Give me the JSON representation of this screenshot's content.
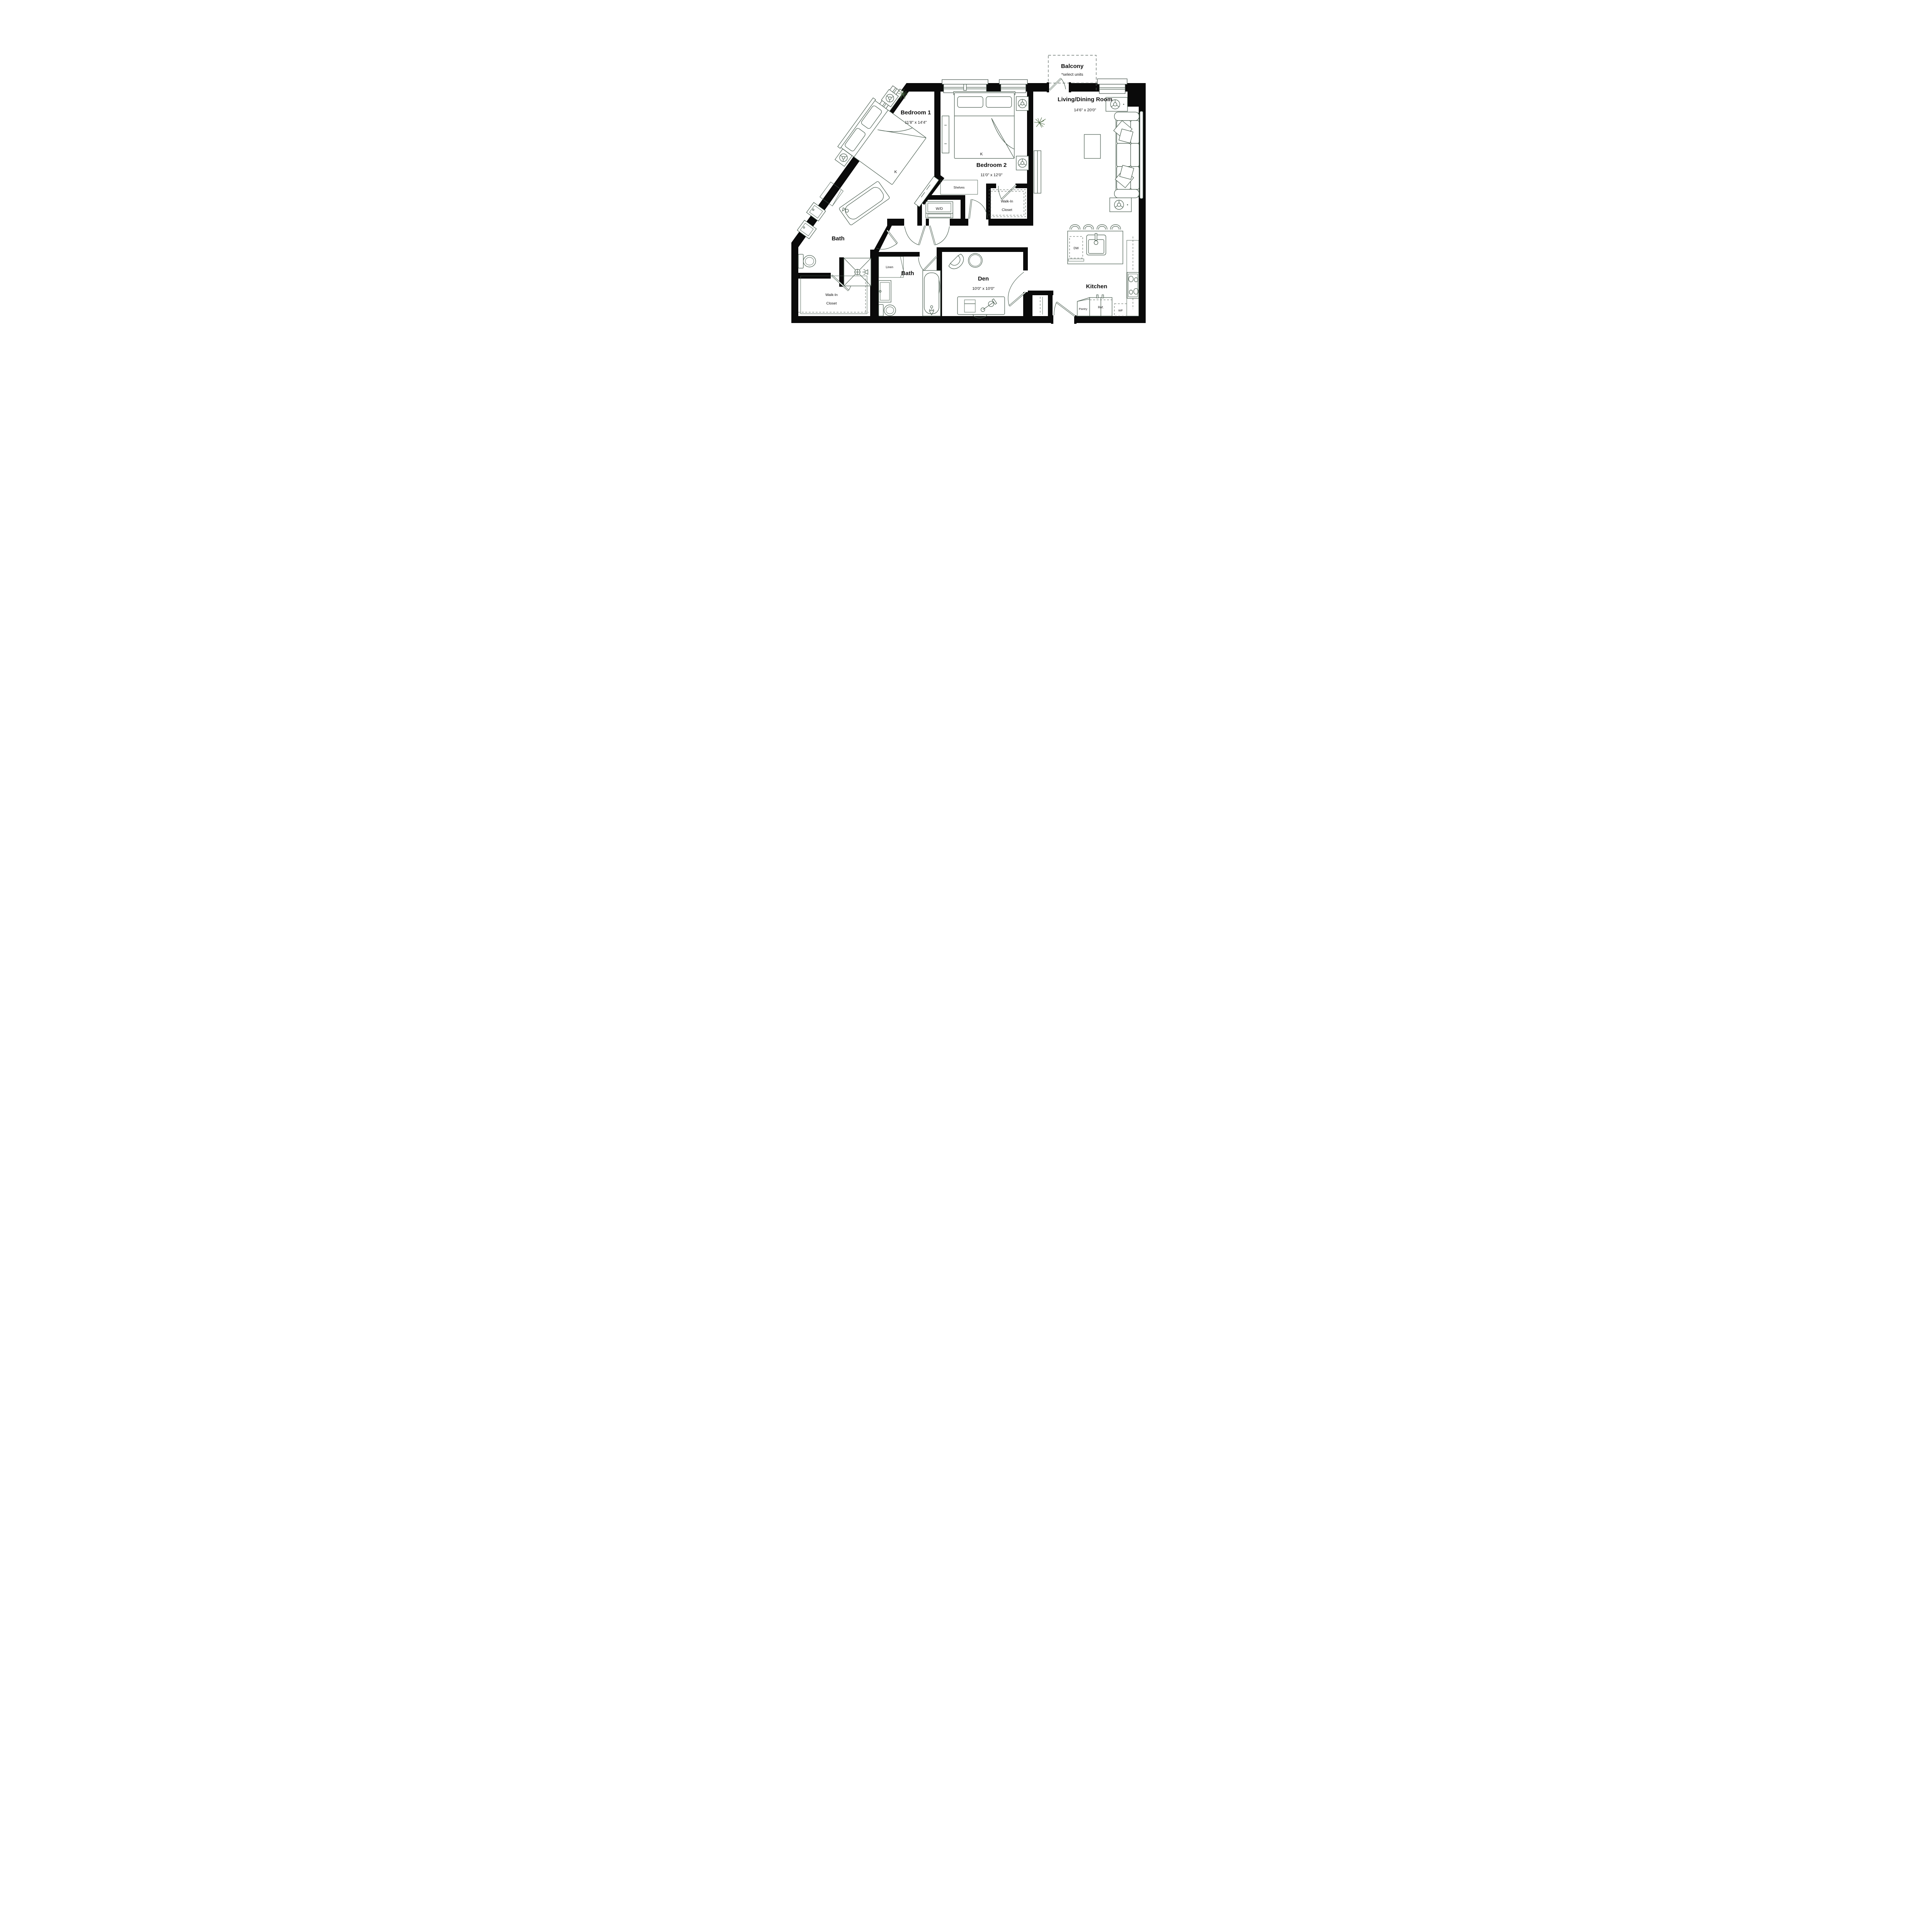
{
  "plan": {
    "rooms": {
      "balcony": {
        "name": "Balcony",
        "note": "*select units"
      },
      "bedroom1": {
        "name": "Bedroom 1",
        "dims": "11'8\" x 14'4\"",
        "bed_label": "K"
      },
      "bedroom2": {
        "name": "Bedroom 2",
        "dims": "11'0\" x 12'0\"",
        "bed_label": "K"
      },
      "living": {
        "name": "Living/Dining Room",
        "dims": "14'6\" x 20'0\""
      },
      "bath1": {
        "name": "Bath"
      },
      "bath2": {
        "name": "Bath"
      },
      "walkin1": {
        "line1": "Walk-In",
        "line2": "Closet"
      },
      "walkin2": {
        "line1": "Walk-In",
        "line2": "Closet"
      },
      "den": {
        "name": "Den",
        "dims": "10'0\" x 10'0\""
      },
      "kitchen": {
        "name": "Kitchen"
      }
    },
    "fixtures": {
      "shelves": "Shelves",
      "washer_dryer": "W/D",
      "linen1": "Linen",
      "linen2": "Linen",
      "dishwasher": "DW",
      "pantry": "Pantry",
      "refrigerator": "Ref.",
      "wine_fridge": "WF"
    },
    "colors": {
      "wall": "#0a0a0a",
      "furniture_line": "#44584a",
      "text": "#101010",
      "plant": "#48663f",
      "background": "#ffffff"
    }
  }
}
